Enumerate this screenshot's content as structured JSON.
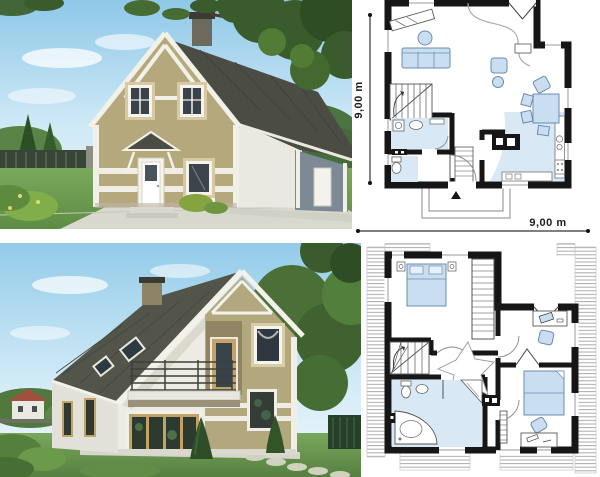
{
  "floor_plans": {
    "ground_floor": {
      "vertical_dimension": "9,00 m",
      "horizontal_dimension": "9,00 m"
    }
  },
  "palette": {
    "plan_wall": "#161616",
    "plan_furniture_fill": "#c9def0",
    "plan_furniture_stroke": "#6b8cad",
    "plan_floor_tint": "#d8e8f5",
    "plan_hatch": "#ababab",
    "facade_olive": "#b4a87d",
    "facade_white": "#eceae2",
    "roof_dark": "#4b4d45",
    "annex_blue_gray": "#7d8a95",
    "window_glass": "#39424a",
    "wood_frame": "#c2a267",
    "sky_top": "#8fc8e8",
    "sky_bottom": "#eef7fb",
    "grass": "#6b9a50",
    "foliage_dark": "#3a5c2c",
    "walkway": "#d8d8cf"
  }
}
